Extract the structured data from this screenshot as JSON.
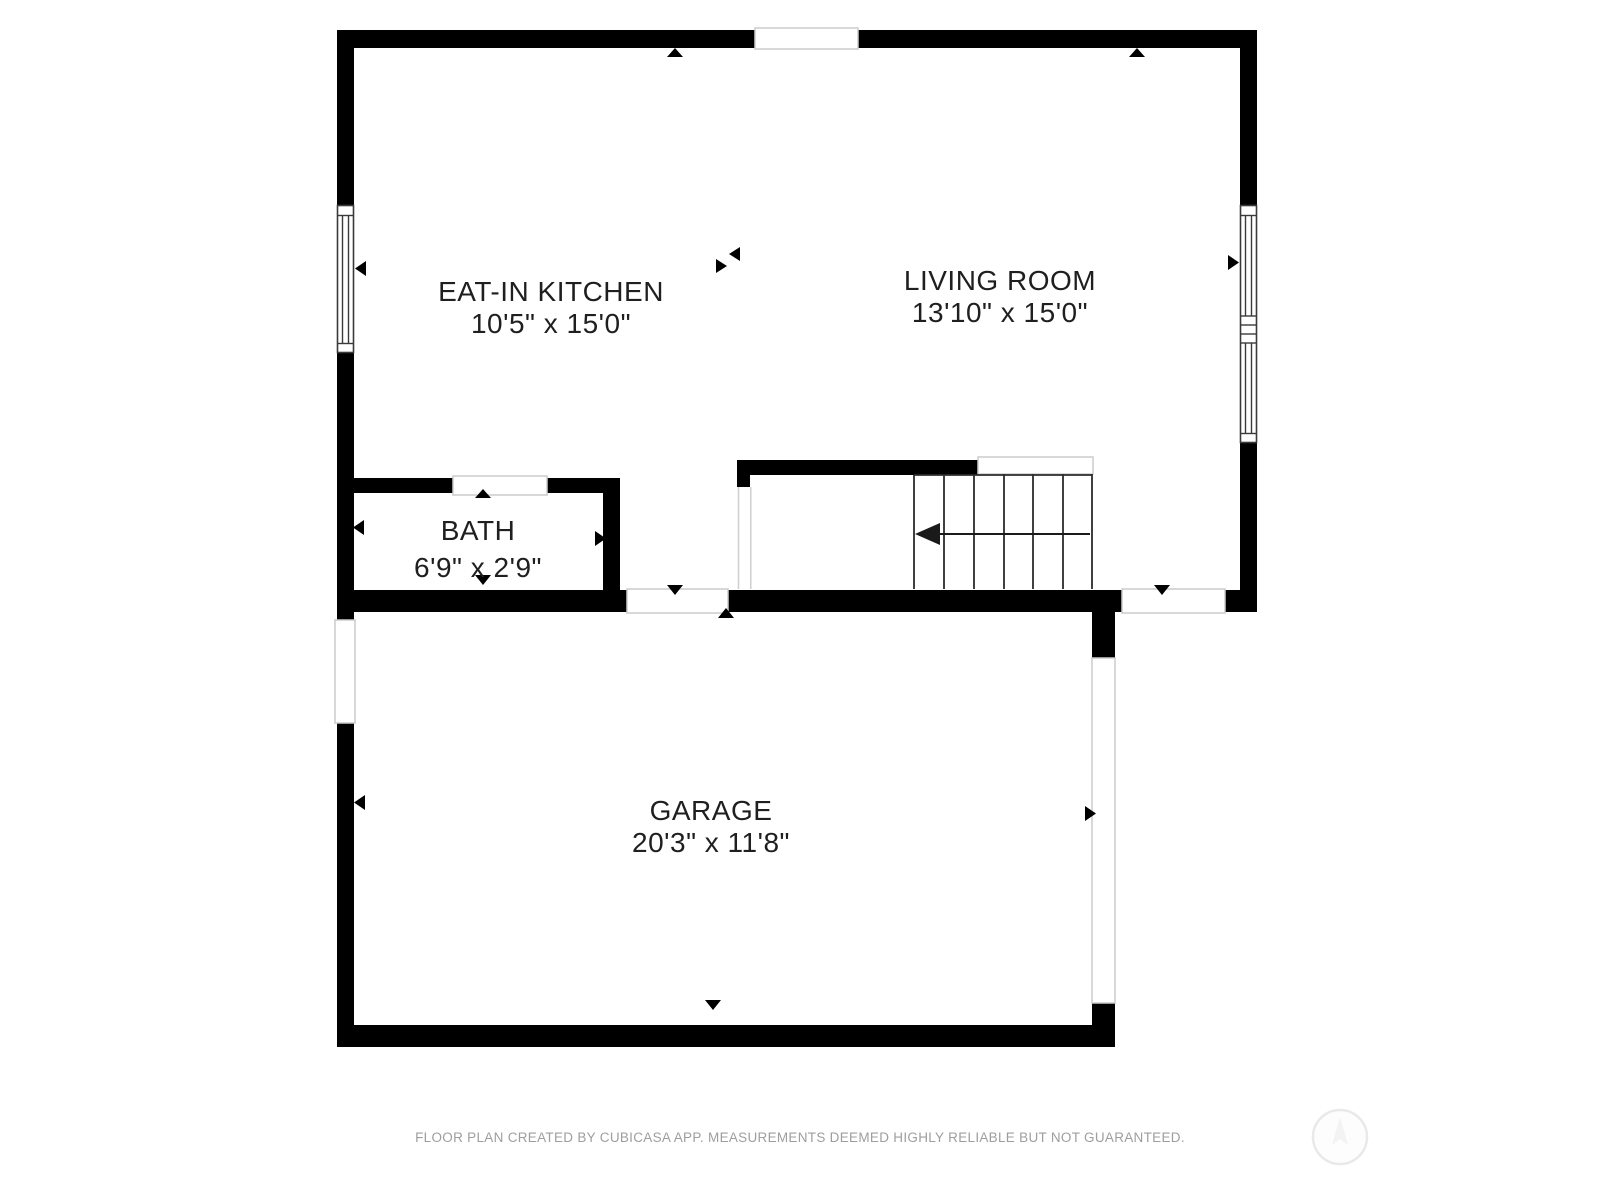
{
  "floor_plan": {
    "creator": "CubiCasa",
    "rooms": [
      {
        "id": "eat-in-kitchen",
        "name": "EAT-IN KITCHEN",
        "dimensions": "10'5\" x 15'0\""
      },
      {
        "id": "living-room",
        "name": "LIVING ROOM",
        "dimensions": "13'10\" x 15'0\""
      },
      {
        "id": "bath",
        "name": "BATH",
        "dimensions": "6'9\" x 2'9\""
      },
      {
        "id": "garage",
        "name": "GARAGE",
        "dimensions": "20'3\" x 11'8\""
      }
    ],
    "footer_text": "FLOOR PLAN CREATED BY CUBICASA APP. MEASUREMENTS DEEMED HIGHLY RELIABLE BUT NOT GUARANTEED.",
    "colors": {
      "wall": "#000000",
      "room_text": "#1f1f1f",
      "footer_text": "#9e9e9e",
      "light_outline": "#cccccc",
      "background": "#ffffff"
    }
  }
}
